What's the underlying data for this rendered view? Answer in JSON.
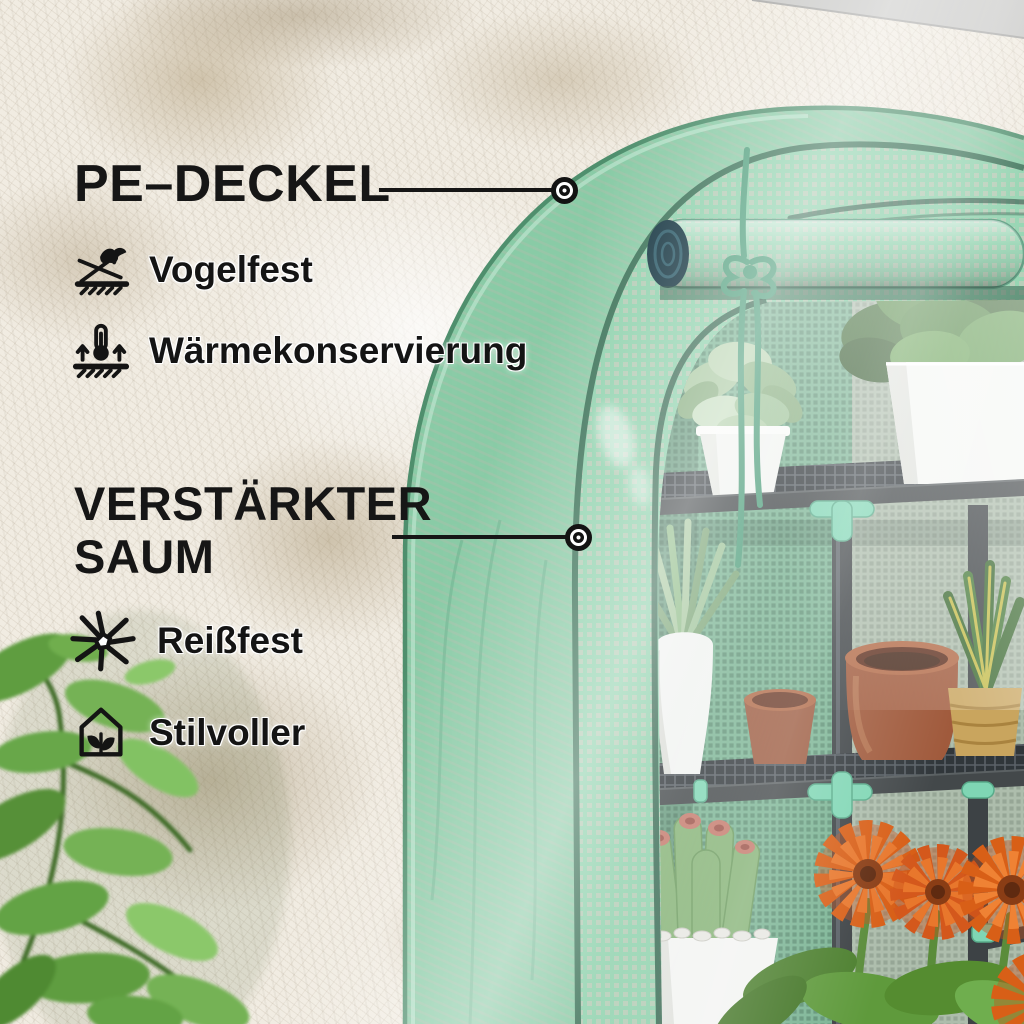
{
  "page": {
    "type": "product-feature-infographic",
    "subject": "mini greenhouse with PE cover",
    "language": "de"
  },
  "callouts": [
    {
      "id": "pe-deckel",
      "title": "PE–DECKEL",
      "points_to": "greenhouse-cover-top",
      "features": [
        {
          "icon": "bird-proof-icon",
          "label": "Vogelfest"
        },
        {
          "icon": "heat-conservation-icon",
          "label": "Wärmekonservierung"
        }
      ]
    },
    {
      "id": "verstaerkter-saum",
      "title": "VERSTÄRKTER SAUM",
      "points_to": "greenhouse-cover-edge-seam",
      "features": [
        {
          "icon": "tear-resistant-icon",
          "label": "Reißfest"
        },
        {
          "icon": "stylish-house-icon",
          "label": "Stilvoller"
        }
      ]
    }
  ],
  "colors": {
    "text": "#161616",
    "wall": "#f1ece2",
    "cover_green": "#8ed1ac",
    "cover_grid_square": "#cfc6ba",
    "cover_edge_dark": "#3c7258",
    "interior_mesh": "#7bb494",
    "connector_mint": "#7fd6b4",
    "frame_dark": "#3d4245",
    "flower_orange": "#d85f17",
    "terracotta": "#a05a3c",
    "foreground_leaf": "#5f9d3f"
  }
}
